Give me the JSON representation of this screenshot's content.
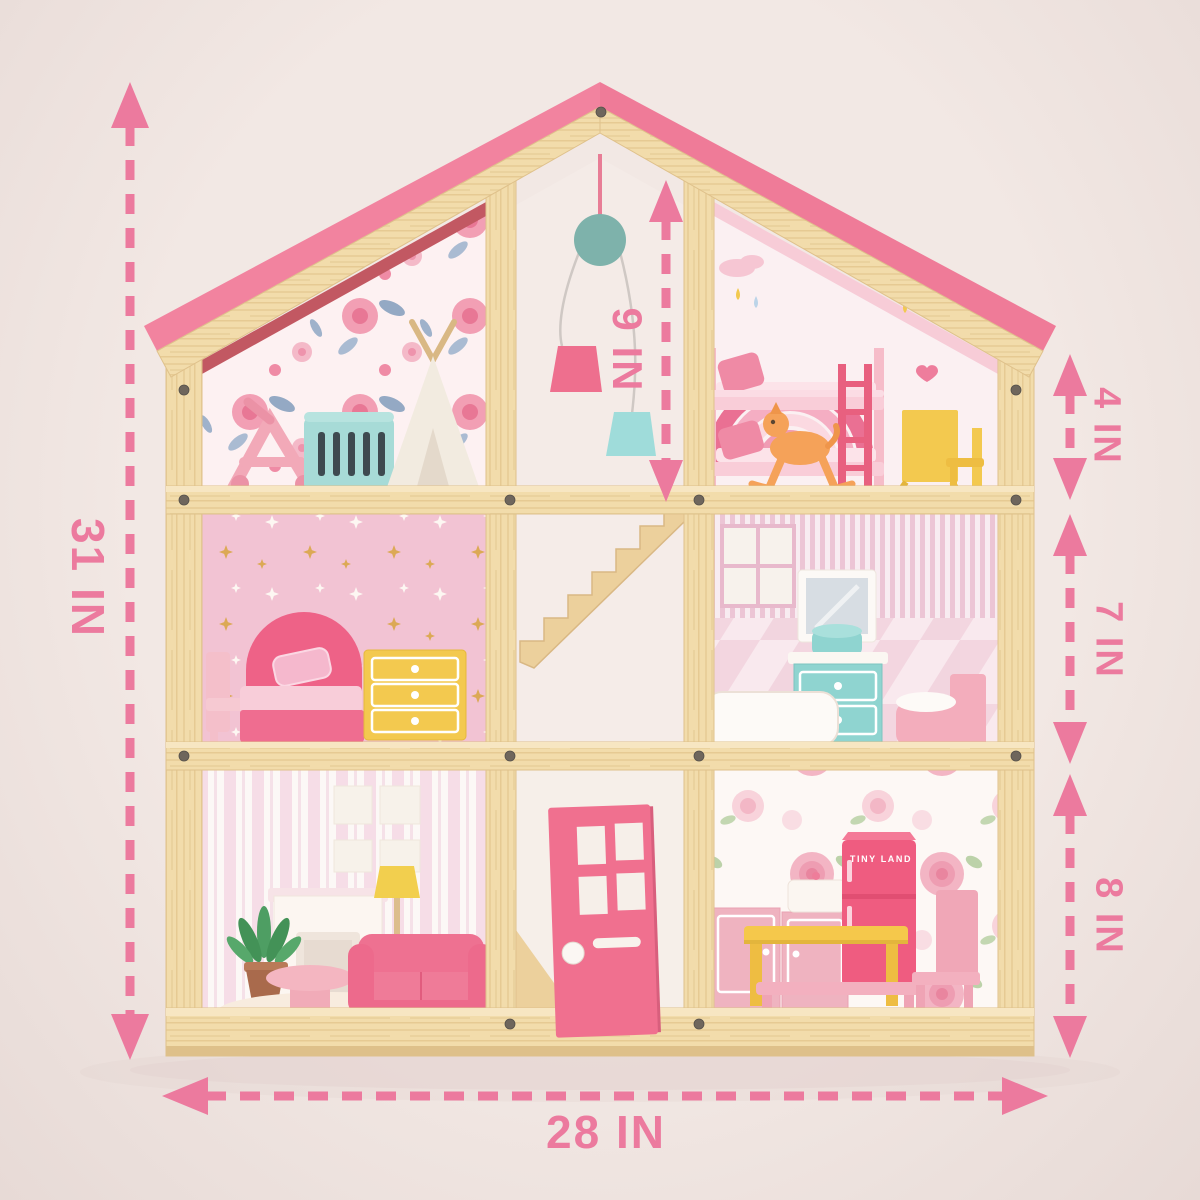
{
  "product_diagram": {
    "dimension_labels": {
      "total_height": "31 IN",
      "total_width": "28 IN",
      "center_opening_height": "9 IN",
      "top_floor_height": "4 IN",
      "middle_floor_height": "7 IN",
      "bottom_floor_height": "8 IN"
    },
    "fridge_text": "TINY LAND"
  },
  "colors": {
    "bg": "#f2e8e4",
    "bg-edge": "#e7dad6",
    "dim": "#ec7a9e",
    "wood": "#f2dcab",
    "wood-dark": "#dfc18b",
    "roof": "#f2839f",
    "roof-dark": "#e96d8d",
    "roof-under": "#c25862",
    "door": "#f0708f",
    "fridge": "#ef5c80",
    "accent-yellow": "#f3c94f",
    "accent-mint": "#98d8d4",
    "accent-pink": "#f2afbe",
    "hot-pink": "#ee6a8c"
  }
}
